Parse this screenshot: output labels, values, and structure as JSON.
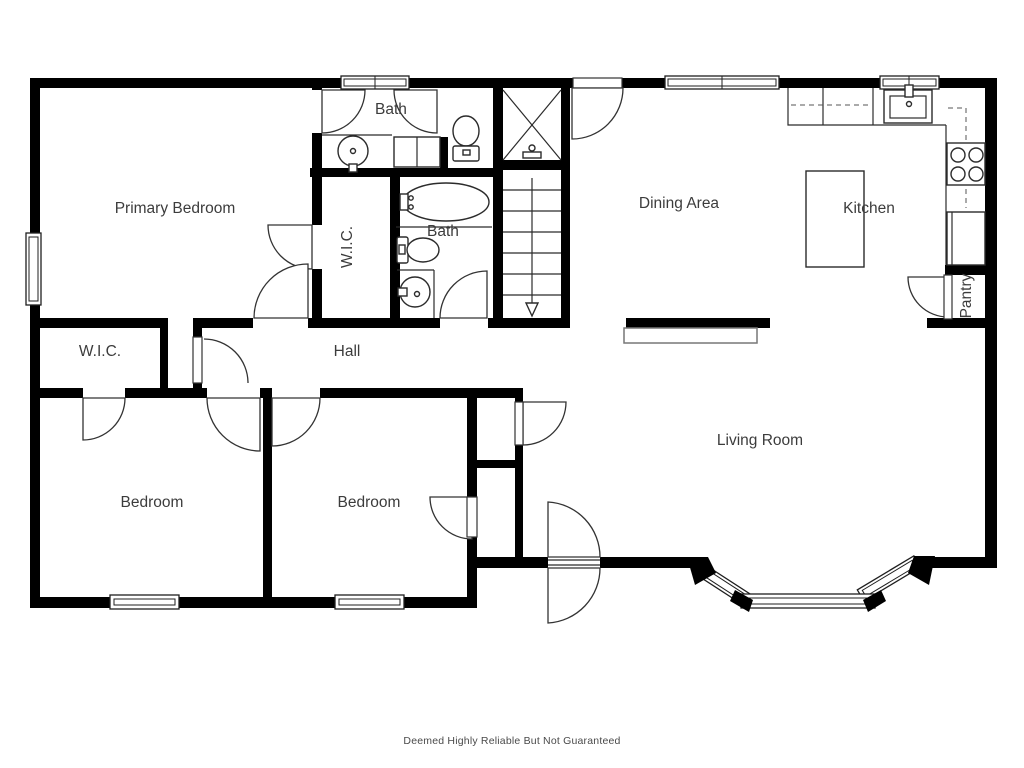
{
  "rooms": {
    "primary_bedroom": {
      "label": "Primary Bedroom"
    },
    "bath_upper": {
      "label": "Bath"
    },
    "bath_hall": {
      "label": "Bath"
    },
    "wic_primary": {
      "label": "W.I.C."
    },
    "wic_hall": {
      "label": "W.I.C."
    },
    "hall": {
      "label": "Hall"
    },
    "dining": {
      "label": "Dining Area"
    },
    "kitchen": {
      "label": "Kitchen"
    },
    "pantry": {
      "label": "Pantry"
    },
    "living": {
      "label": "Living Room"
    },
    "bedroom_left": {
      "label": "Bedroom"
    },
    "bedroom_mid": {
      "label": "Bedroom"
    }
  },
  "footer": {
    "disclaimer": "Deemed Highly Reliable But Not Guaranteed"
  },
  "icons": [
    "shower-icon",
    "bathtub-icon",
    "toilet-icon",
    "sink-icon",
    "stove-icon",
    "kitchen-sink-icon",
    "refrigerator-icon",
    "staircase-icon",
    "stairs-down-arrow-icon",
    "window-icon",
    "door-swing-icon"
  ],
  "colors": {
    "wall": "#000000",
    "line": "#2b2b2b",
    "label_text": "#3c3c3c",
    "footer_text": "#4a4a4a",
    "background": "#ffffff"
  }
}
